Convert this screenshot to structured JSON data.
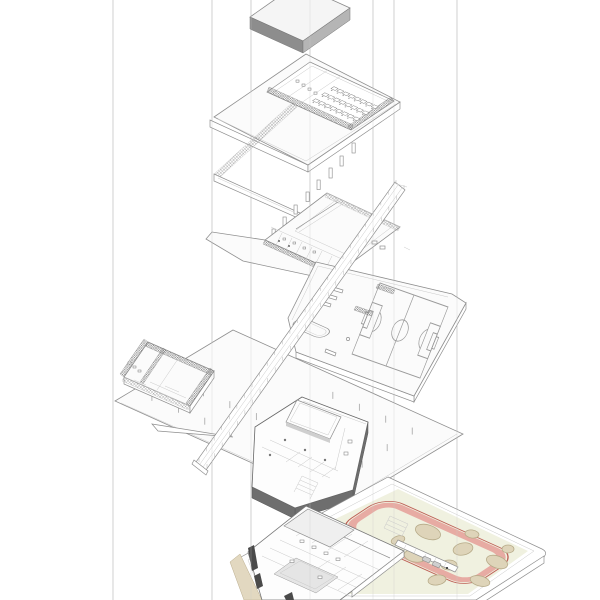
{
  "diagram": {
    "kind": "exploded-axonometric-building-diagram",
    "levels": [
      "roof-slab",
      "upper-floor",
      "classroom-floor",
      "sports-court-terrace",
      "hall-floor",
      "lower-floor-slab",
      "site-plan"
    ]
  },
  "palette": {
    "line": "#8f8f8f",
    "line_light": "#c9c9c9",
    "paper": "#fbfbfb",
    "hatch": "#5f5f5f",
    "roof_dark": "#8d8d8d",
    "roof_mid": "#b5b5b5",
    "slab_dark": "#6e6e6e",
    "site_field": "#f0f1e0",
    "track_pink": "#e7aba3",
    "track_red": "#b5463e",
    "sand": "#ded4b9",
    "sand_line": "#b7ab89",
    "deck": "#e2d8c0"
  },
  "guides": {
    "x_positions": [
      113,
      212,
      251,
      310,
      373,
      394,
      457
    ]
  },
  "upper_floor": {
    "desk_rows": 3,
    "desk_cols": 8
  },
  "hall_floor": {
    "column_tick_rows": 4,
    "column_tick_cols": 8
  },
  "ramp": {
    "tick_count": 26
  },
  "site": {
    "sand_blobs": [
      {
        "cx": 428,
        "cy": 532,
        "rx": 13,
        "ry": 7,
        "rot": 18
      },
      {
        "cx": 463,
        "cy": 549,
        "rx": 10,
        "ry": 6,
        "rot": -12
      },
      {
        "cx": 497,
        "cy": 562,
        "rx": 11,
        "ry": 6,
        "rot": 20
      },
      {
        "cx": 449,
        "cy": 565,
        "rx": 8,
        "ry": 5,
        "rot": 0
      },
      {
        "cx": 415,
        "cy": 556,
        "rx": 11,
        "ry": 6,
        "rot": 10
      },
      {
        "cx": 480,
        "cy": 581,
        "rx": 10,
        "ry": 5,
        "rot": 14
      },
      {
        "cx": 508,
        "cy": 549,
        "rx": 6,
        "ry": 4,
        "rot": 0
      },
      {
        "cx": 437,
        "cy": 580,
        "rx": 9,
        "ry": 5,
        "rot": -8
      },
      {
        "cx": 398,
        "cy": 540,
        "rx": 7,
        "ry": 4,
        "rot": -18
      },
      {
        "cx": 472,
        "cy": 534,
        "rx": 7,
        "ry": 4,
        "rot": 8
      }
    ]
  }
}
